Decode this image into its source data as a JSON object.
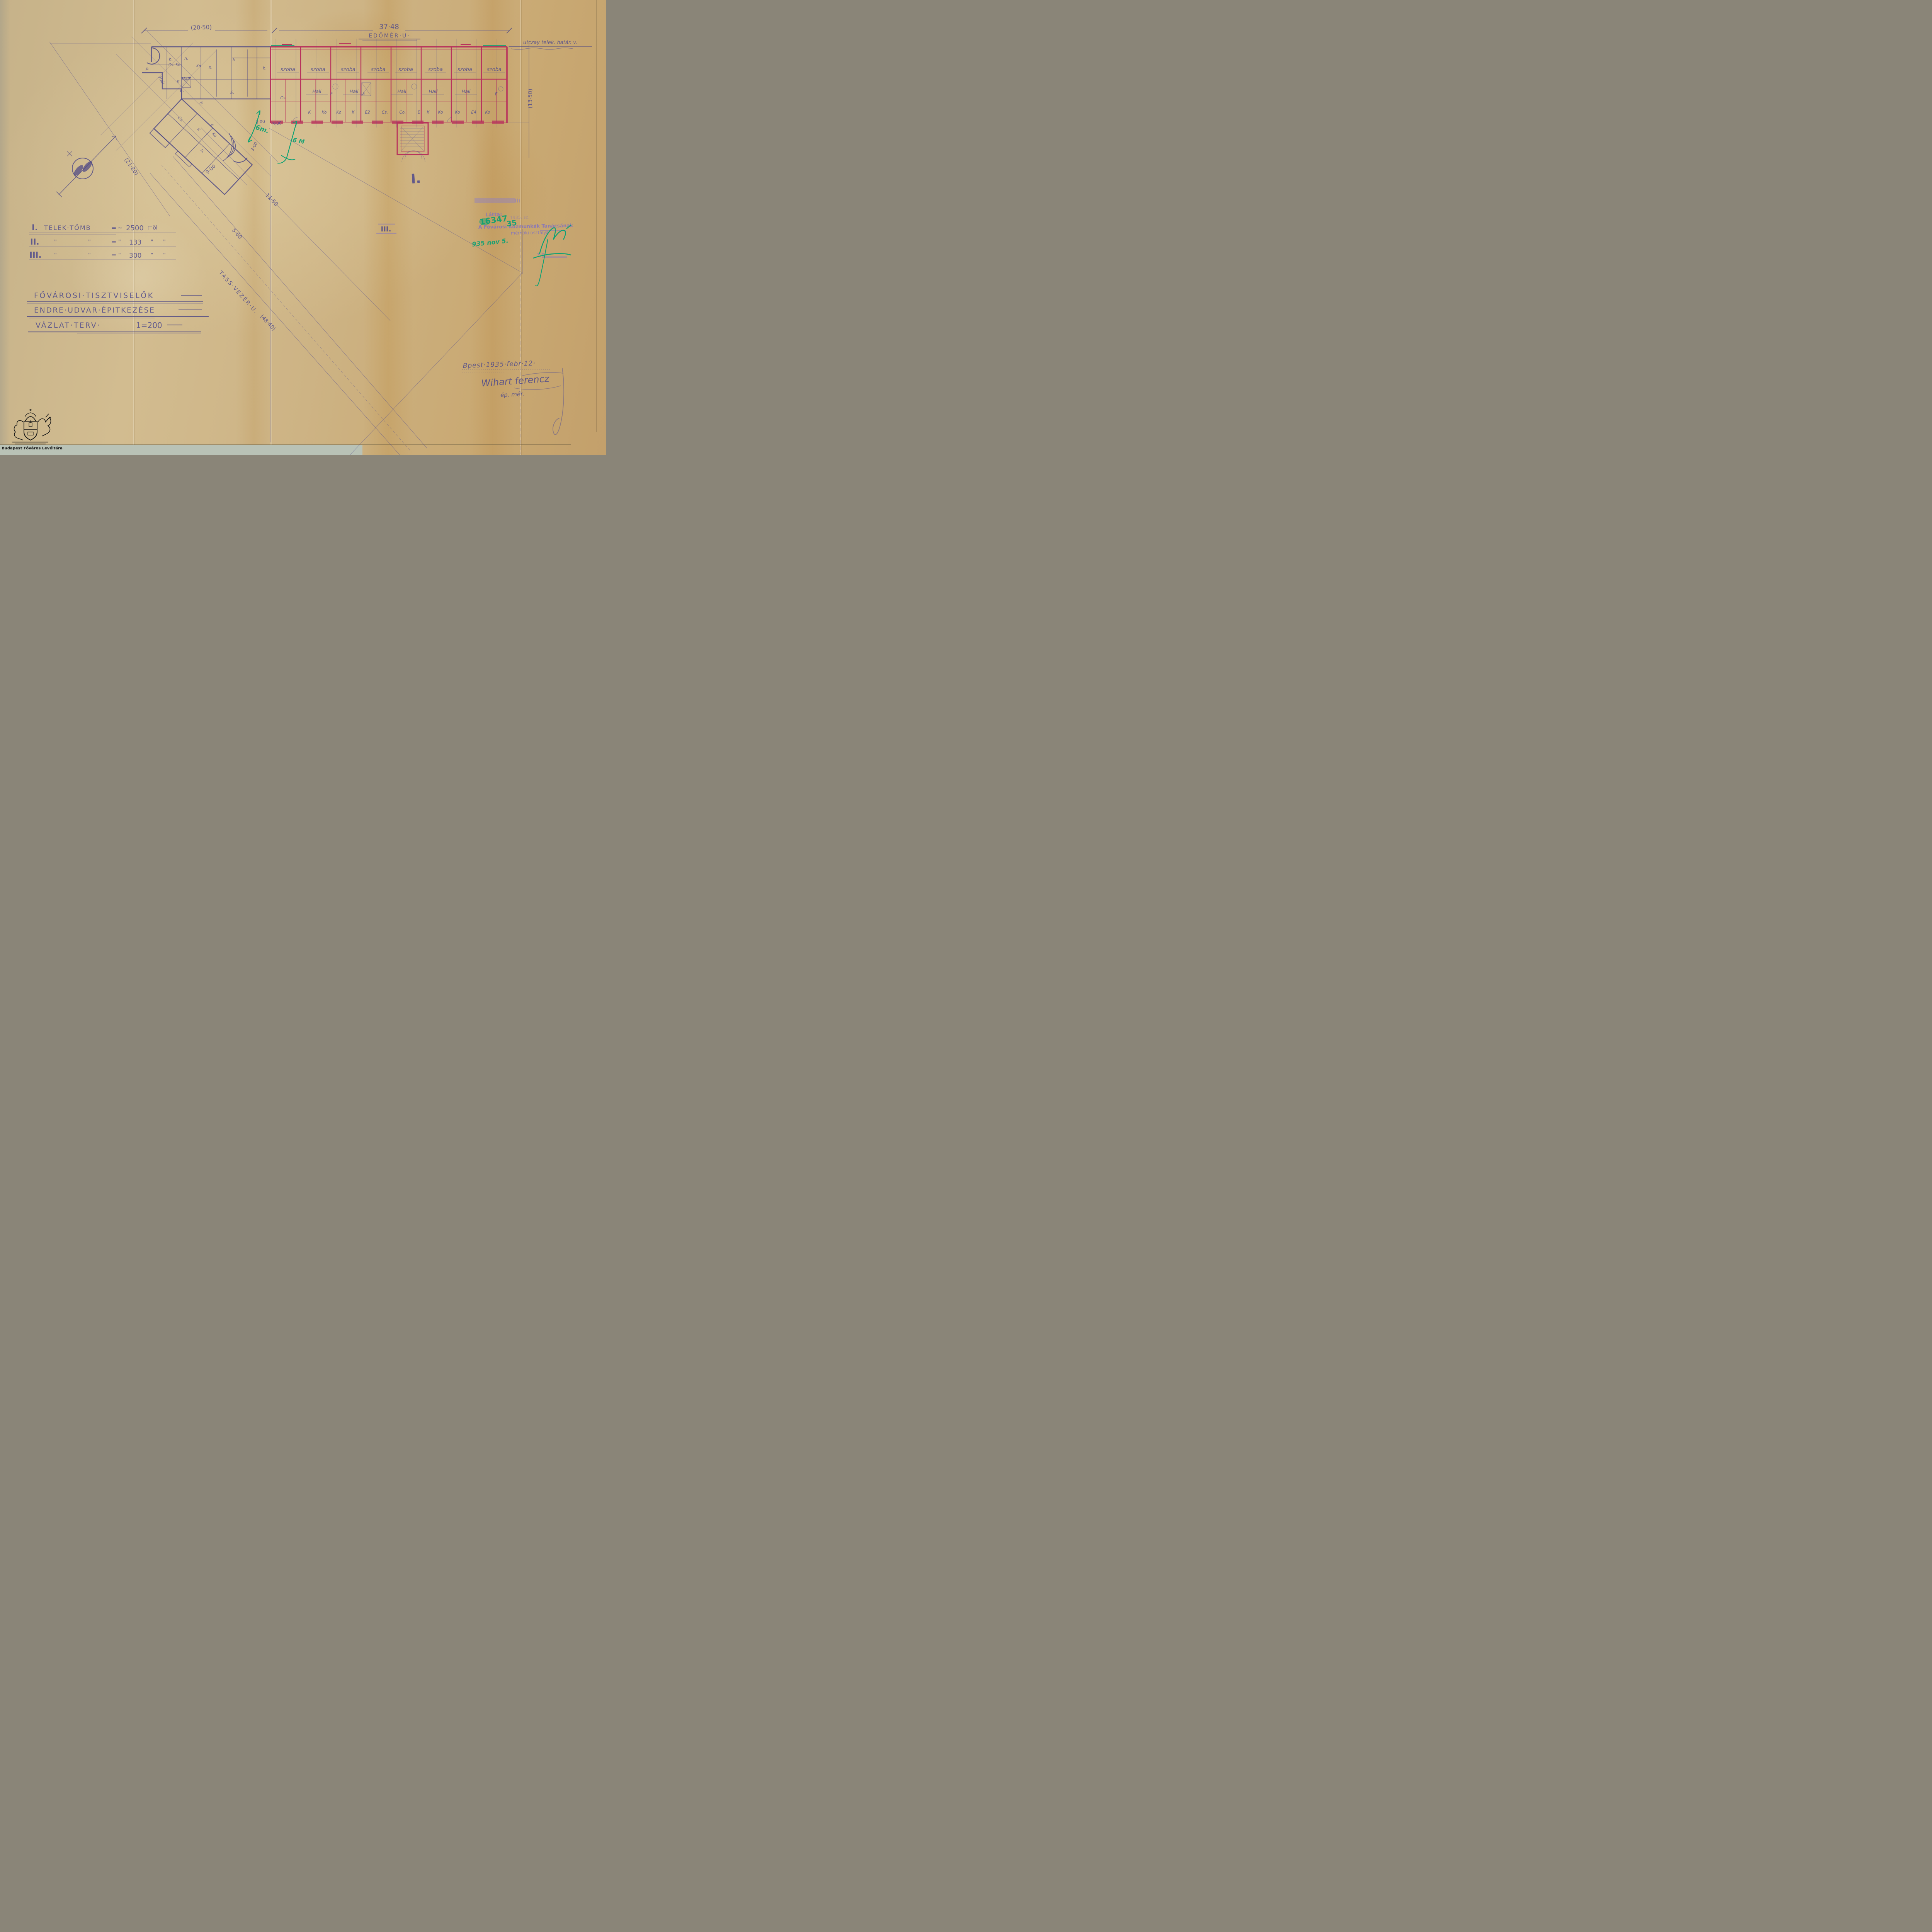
{
  "page": {
    "archive_caption": "Budapest Főváros Levéltára"
  },
  "streets": {
    "top_street": "EDÖMÉR·U·",
    "diagonal_street": "TASS·VEZÉR·U.",
    "boundary_label": "utczay telek. határ. v."
  },
  "dims": {
    "d20_50": "(20·50)",
    "d37_48": "37·48",
    "d13_50": "(13·50)",
    "d21_80": "(21·80)",
    "d48_40": "(48·40)",
    "d5_60": "5·60",
    "d11_50": "11·50",
    "d9_00": "9·00",
    "d3_00a": "3·00",
    "d3_00b": "3·00",
    "d3_00c": "3·00"
  },
  "markers": {
    "block_I": "I.",
    "block_III": "III."
  },
  "area_table": {
    "rows": [
      {
        "num": "I.",
        "label": "TELEK·TÖMB",
        "eq": "=",
        "approx": "~",
        "value": "2500",
        "unit": "□öl"
      },
      {
        "num": "II.",
        "d1": "\"",
        "d2": "\"",
        "eq": "=",
        "d3": "\"",
        "value": "133",
        "d4": "\"",
        "d5": "\""
      },
      {
        "num": "III.",
        "d1": "\"",
        "d2": "\"",
        "eq": "=",
        "d3": "\"",
        "value": "300",
        "d4": "\"",
        "d5": "\""
      }
    ]
  },
  "title_block": {
    "line1": "FŐVÁROSI·TISZTVISELŐK",
    "line2": "ENDRE·UDVAR·ÉPITKEZÉSE",
    "line3": "VÁZLAT·TERV·",
    "scale": "1=200"
  },
  "plan": {
    "szoba": [
      "szoba",
      "szoba",
      "szoba",
      "szoba",
      "szoba",
      "szoba",
      "szoba",
      "szoba"
    ],
    "halls": [
      "Hall",
      "Hall",
      "Hall",
      "Hall",
      "Hall"
    ],
    "f1": "F",
    "f2": "F",
    "f3": "F",
    "cs": "Cs.",
    "bottom": [
      "K",
      "Ko",
      "Ko",
      "K",
      "É2",
      "Cs.",
      "Co.",
      "É",
      "K",
      "Ko",
      "Ko",
      "É4",
      "Ko"
    ],
    "left_labels": [
      "h.",
      "p.",
      "h.",
      "Cs. Ko",
      "Ko",
      "h.",
      "Hall",
      "Hall",
      "K",
      "É.",
      "Cs.",
      "h.",
      "É",
      "K",
      "h.",
      "Ko",
      "h",
      "h.",
      "É."
    ]
  },
  "stamp": {
    "latta": "Látta:",
    "ref": "1935. sz.",
    "org": "A Fővárosi Közmunkák Tanácsának",
    "dept": "mérnöki osztálya",
    "min": "min"
  },
  "green": {
    "num": "16347",
    "num2": "35",
    "date": "935 nov 5.",
    "m1": "6m.",
    "m2": "6 M"
  },
  "footer": {
    "date": "Bpest·1935·febr·12·",
    "name": "Wihart ferencz",
    "role": "ép. mér."
  }
}
